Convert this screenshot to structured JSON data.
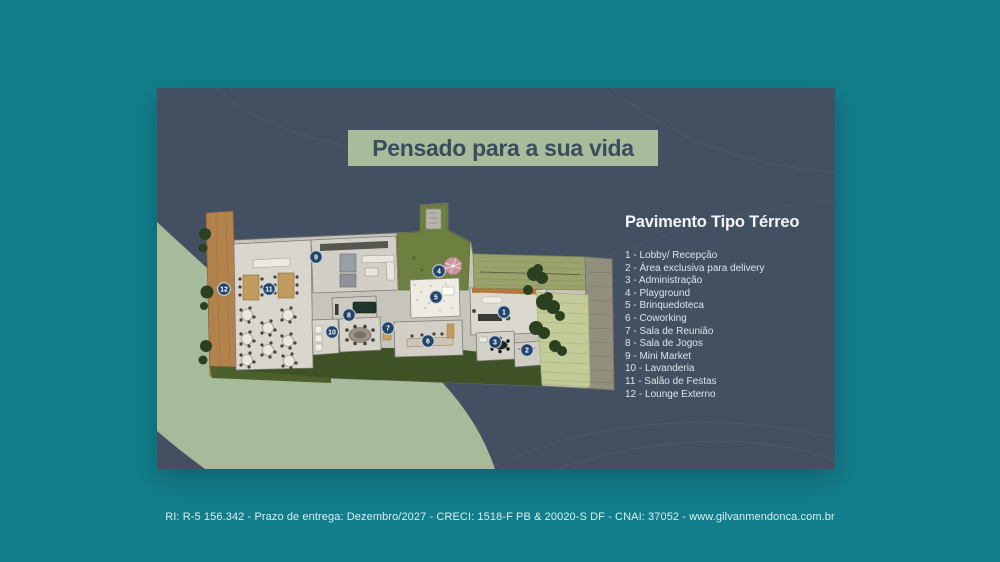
{
  "page": {
    "background_color": "#137E8B",
    "footer_text": "RI: R-5 156.342 - Prazo de entrega: Dezembro/2027 - CRECI: 1518-F PB & 20020-S DF - CNAI: 37052 - www.gilvanmendonca.com.br"
  },
  "card": {
    "background_color": "#435062",
    "accent_color": "#A6BC9A",
    "title": "Pensado para a sua vida",
    "plan_heading": "Pavimento Tipo Térreo",
    "legend": {
      "items": [
        "1 - Lobby/ Recepção",
        "2 - Área exclusiva para delivery",
        "3 - Administração",
        "4 - Playground",
        "5 - Brinquedoteca",
        "6 - Coworking",
        "7 - Sala de Reunião",
        "8 - Sala de Jogos",
        "9 - Mini Market",
        "10 - Lavanderia",
        "11 - Salão de Festas",
        "12 - Lounge Externo"
      ]
    },
    "plan": {
      "badge_color": "#24456A",
      "badges": [
        "1",
        "2",
        "3",
        "4",
        "5",
        "6",
        "7",
        "8",
        "9",
        "10",
        "11",
        "12"
      ]
    }
  }
}
